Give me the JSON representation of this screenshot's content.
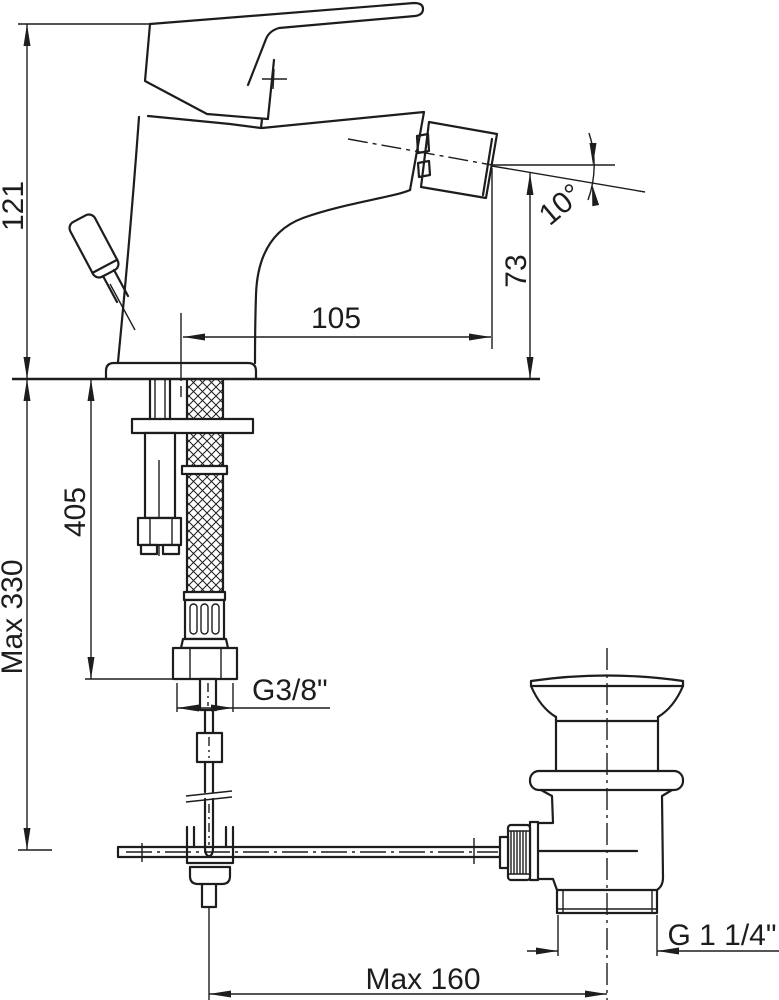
{
  "drawing": {
    "background": "#ffffff",
    "line_color": "#1d1d1d",
    "dimensions": {
      "total_height": "121",
      "max_deck_thickness": "Max 330",
      "hose_length": "405",
      "spout_reach": "105",
      "spout_height": "73",
      "spout_angle": "10°",
      "supply_thread": "G3/8\"",
      "waste_thread": "G 1 1/4\"",
      "rod_max_reach": "Max 160"
    }
  }
}
